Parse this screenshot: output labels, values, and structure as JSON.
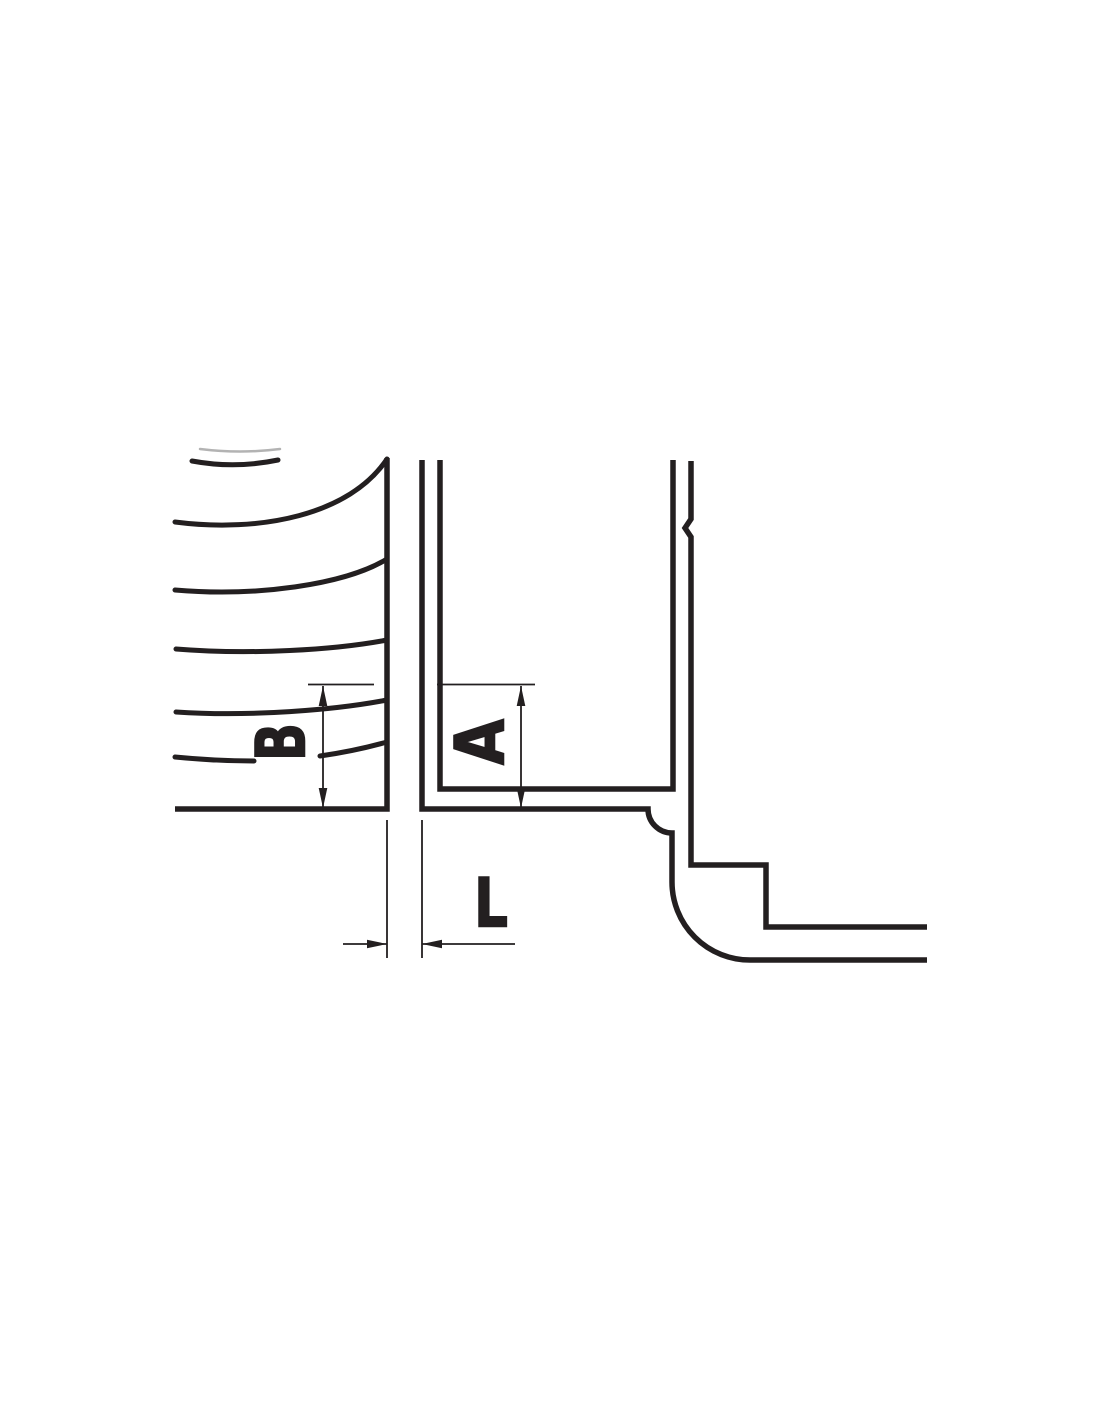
{
  "diagram": {
    "description": "Engineering cross-section detail drawing with clearance and depth dimensions",
    "line_color": "#231f20",
    "faint_line_color": "#b3b3b3",
    "background_color": "#ffffff",
    "dimensions": {
      "b_label": "B",
      "a_label": "A",
      "l_label": "L"
    }
  }
}
